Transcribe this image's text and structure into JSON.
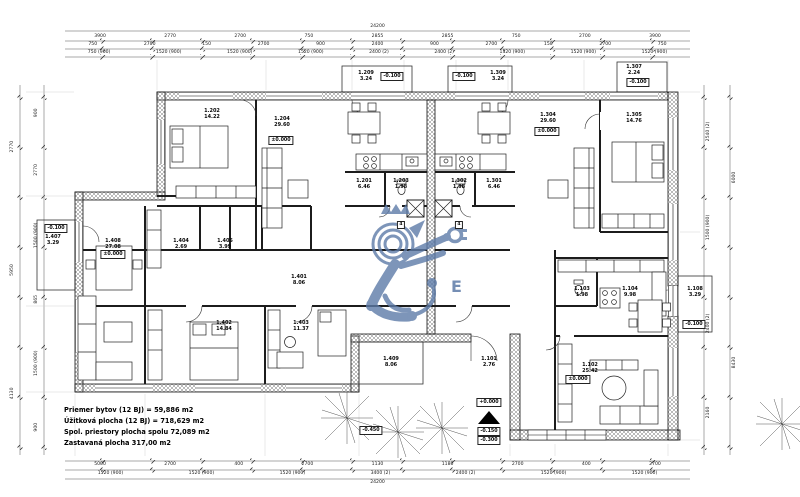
{
  "summary": {
    "line1": "Priemer bytov (12 BJ) = 59,886 m2",
    "line2": "Úžitková plocha (12 BJ) = 718,629 m2",
    "line3": "Spol. priestory plocha spolu 72,089 m2",
    "line4": "Zastavaná plocha 317,00 m2"
  },
  "watermark": {
    "letter": "E",
    "color": "#5d7ba8"
  },
  "elevations": {
    "zero": "±0.000",
    "zero_plus": "+0.000",
    "minus_100": "-0.100",
    "minus_150": "-0.150",
    "minus_300": "-0.300",
    "minus_450": "-0.450"
  },
  "shaft_label": "4",
  "rooms": [
    {
      "num": "1.202",
      "area": "14.22"
    },
    {
      "num": "1.204",
      "area": "29.60"
    },
    {
      "num": "1.209",
      "area": "3.24"
    },
    {
      "num": "1.309",
      "area": "3.24"
    },
    {
      "num": "1.307",
      "area": "2.24"
    },
    {
      "num": "1.201",
      "area": "6.46"
    },
    {
      "num": "1.203",
      "area": "1.98"
    },
    {
      "num": "1.302",
      "area": "1.98"
    },
    {
      "num": "1.301",
      "area": "6.46"
    },
    {
      "num": "1.304",
      "area": "29.60"
    },
    {
      "num": "1.305",
      "area": "14.76"
    },
    {
      "num": "1.407",
      "area": "3.29"
    },
    {
      "num": "1.408",
      "area": "27.08"
    },
    {
      "num": "1.404",
      "area": "2.69"
    },
    {
      "num": "1.405",
      "area": "3.99"
    },
    {
      "num": "1.401",
      "area": "8.06"
    },
    {
      "num": "1.402",
      "area": "14.84"
    },
    {
      "num": "1.403",
      "area": "11.37"
    },
    {
      "num": "1.409",
      "area": "8.06"
    },
    {
      "num": "1.101",
      "area": "2.76"
    },
    {
      "num": "1.103",
      "area": "1.98"
    },
    {
      "num": "1.104",
      "area": "9.98"
    },
    {
      "num": "1.102",
      "area": "25.42"
    },
    {
      "num": "1.108",
      "area": "3.29"
    }
  ],
  "dimensions": {
    "top1": [
      "24200"
    ],
    "top2": [
      "3900",
      "2770",
      "2700",
      "750",
      "2855",
      "2855",
      "750",
      "2700",
      "3900"
    ],
    "top3": [
      "750",
      "2700",
      "150",
      "2700",
      "900",
      "2400",
      "900",
      "2700",
      "150",
      "2700",
      "750"
    ],
    "top4": [
      "750 (900)",
      "1520 (900)",
      "1520 (900)",
      "1520 (900)",
      "2400 (2)",
      "2400 (2)",
      "1520 (900)",
      "1520 (900)",
      "1520 (900)"
    ],
    "bottom1": [
      "5000",
      "2700",
      "400",
      "2700",
      "1130",
      "1180",
      "2700",
      "400",
      "2700"
    ],
    "bottom2": [
      "1520 (900)",
      "1520 (900)",
      "1520 (900)",
      "3400 (2)",
      "2400 (2)",
      "1520 (900)",
      "1520 (900)"
    ],
    "bottom3": [
      "24200"
    ],
    "left1": [
      "4130",
      "5950",
      "2770"
    ],
    "left2": [
      "900",
      "1500 (900)",
      "865",
      "1500 (900)",
      "2770",
      "900"
    ],
    "right1": [
      "2160",
      "2400 (2)",
      "1500 (900)",
      "2540 (2)"
    ],
    "right2": [
      "8430",
      "6000"
    ]
  }
}
